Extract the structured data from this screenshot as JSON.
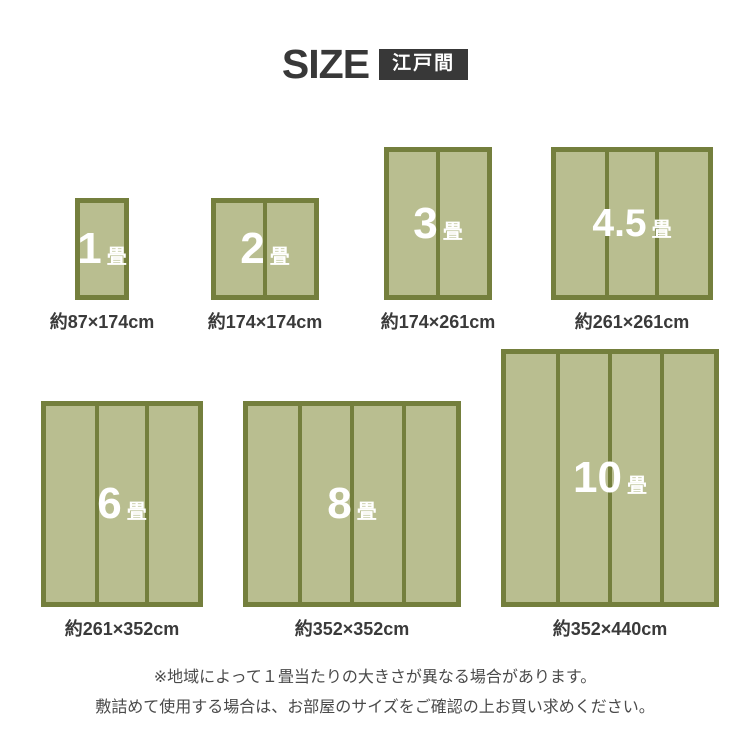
{
  "header": {
    "title": "SIZE",
    "badge": "江戸間"
  },
  "mats": [
    {
      "number": "1",
      "unit": "畳",
      "dimension": "約87×174cm"
    },
    {
      "number": "2",
      "unit": "畳",
      "dimension": "約174×174cm"
    },
    {
      "number": "3",
      "unit": "畳",
      "dimension": "約174×261cm"
    },
    {
      "number": "4.5",
      "unit": "畳",
      "dimension": "約261×261cm"
    },
    {
      "number": "6",
      "unit": "畳",
      "dimension": "約261×352cm"
    },
    {
      "number": "8",
      "unit": "畳",
      "dimension": "約352×352cm"
    },
    {
      "number": "10",
      "unit": "畳",
      "dimension": "約352×440cm"
    }
  ],
  "notes": {
    "line1": "※地域によって１畳当たりの大きさが異なる場合があります。",
    "line2": "敷詰めて使用する場合は、お部屋のサイズをご確認の上お買い求めください。"
  },
  "colors": {
    "mat_fill": "#b9be90",
    "mat_border": "#747f3d",
    "title_text": "#383838",
    "badge_bg": "#383838",
    "badge_text": "#ffffff",
    "mat_label_text": "#ffffff",
    "dimension_text": "#3a3a3a",
    "note_text": "#4a4a4a"
  }
}
